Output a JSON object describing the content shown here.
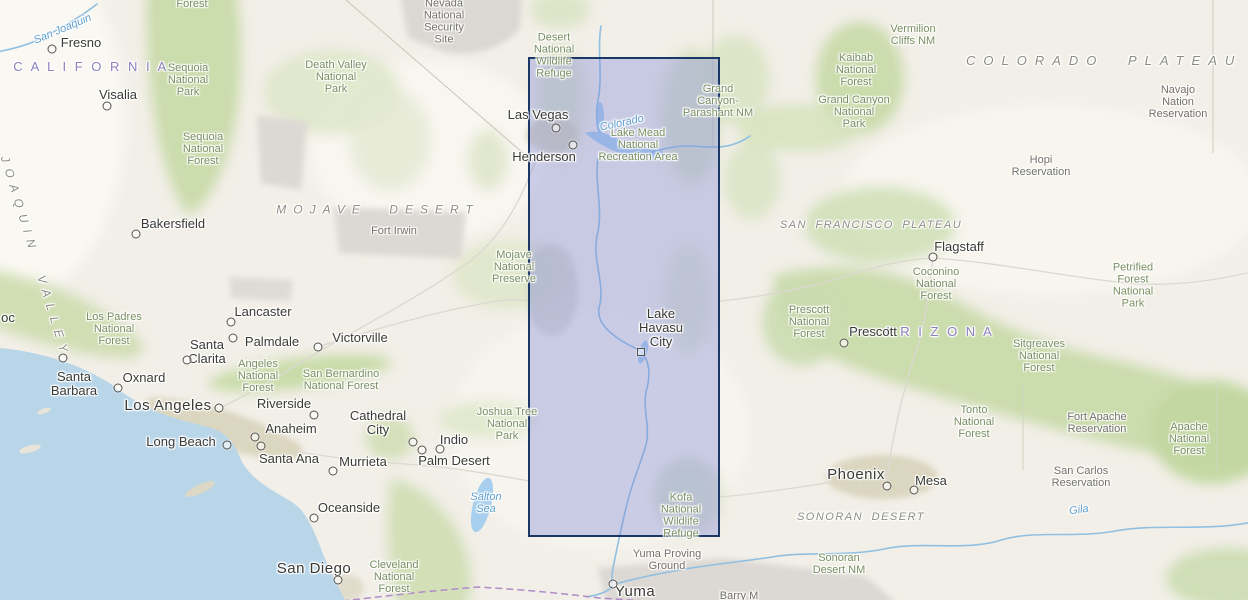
{
  "map": {
    "colors": {
      "base": "#f2efe8",
      "ocean": "#b9d6e9",
      "lake": "#a8d0ee",
      "river": "#8fc0e2",
      "forest": "#c6d9a6",
      "selection_fill": "rgba(125,132,215,0.36)",
      "selection_border": "#1b3766",
      "state_label": "#8d80bd",
      "park_label": "#7a8f63",
      "city_label": "#3a3a37",
      "river_label": "#5f9fcd"
    },
    "selection_rectangle": {
      "left": 528,
      "top": 57,
      "width": 192,
      "height": 480
    },
    "city_labels": [
      {
        "name": "Fresno",
        "x": 81,
        "y": 43,
        "dot_x": 52,
        "dot_y": 49
      },
      {
        "name": "Visalia",
        "x": 118,
        "y": 95,
        "dot_x": 107,
        "dot_y": 106
      },
      {
        "name": "Bakersfield",
        "x": 173,
        "y": 224,
        "dot_x": 136,
        "dot_y": 234
      },
      {
        "name": "Las Vegas",
        "x": 538,
        "y": 115,
        "dot_x": 556,
        "dot_y": 128
      },
      {
        "name": "Henderson",
        "x": 544,
        "y": 157,
        "dot_x": 573,
        "dot_y": 145
      },
      {
        "name": "Lancaster",
        "x": 263,
        "y": 312,
        "dot_x": 231,
        "dot_y": 322
      },
      {
        "name": "Santa\nClarita",
        "x": 207,
        "y": 352,
        "dot_x": 187,
        "dot_y": 360
      },
      {
        "name": "Palmdale",
        "x": 272,
        "y": 342,
        "dot_x": 233,
        "dot_y": 338
      },
      {
        "name": "Victorville",
        "x": 360,
        "y": 338,
        "dot_x": 318,
        "dot_y": 347
      },
      {
        "name": "Santa\nBarbara",
        "x": 74,
        "y": 384,
        "dot_x": 63,
        "dot_y": 358
      },
      {
        "name": "Oxnard",
        "x": 144,
        "y": 378,
        "dot_x": 118,
        "dot_y": 388
      },
      {
        "name": "Los Angeles",
        "x": 168,
        "y": 406,
        "dot_x": 219,
        "dot_y": 408,
        "major": true
      },
      {
        "name": "Riverside",
        "x": 284,
        "y": 404,
        "dot_x": 314,
        "dot_y": 415
      },
      {
        "name": "Anaheim",
        "x": 291,
        "y": 429,
        "dot_x": 255,
        "dot_y": 437
      },
      {
        "name": "Long Beach",
        "x": 181,
        "y": 442,
        "dot_x": 227,
        "dot_y": 445
      },
      {
        "name": "Santa Ana",
        "x": 289,
        "y": 459,
        "dot_x": 261,
        "dot_y": 446
      },
      {
        "name": "Murrieta",
        "x": 363,
        "y": 462,
        "dot_x": 333,
        "dot_y": 471
      },
      {
        "name": "Cathedral\nCity",
        "x": 378,
        "y": 423,
        "dot_x": 413,
        "dot_y": 442
      },
      {
        "name": "Indio",
        "x": 454,
        "y": 440,
        "dot_x": 440,
        "dot_y": 449
      },
      {
        "name": "Palm Desert",
        "x": 454,
        "y": 461,
        "dot_x": 422,
        "dot_y": 450
      },
      {
        "name": "Lake\nHavasu\nCity",
        "x": 661,
        "y": 328,
        "dot_x": 641,
        "dot_y": 352,
        "marker": "square"
      },
      {
        "name": "Flagstaff",
        "x": 959,
        "y": 247,
        "dot_x": 933,
        "dot_y": 257
      },
      {
        "name": "Prescott",
        "x": 873,
        "y": 332,
        "dot_x": 844,
        "dot_y": 343
      },
      {
        "name": "Phoenix",
        "x": 856,
        "y": 475,
        "dot_x": 887,
        "dot_y": 486,
        "major": true
      },
      {
        "name": "Mesa",
        "x": 931,
        "y": 481,
        "dot_x": 914,
        "dot_y": 490
      },
      {
        "name": "Oceanside",
        "x": 349,
        "y": 508,
        "dot_x": 314,
        "dot_y": 518
      },
      {
        "name": "San Diego",
        "x": 314,
        "y": 569,
        "dot_x": 338,
        "dot_y": 580,
        "major": true
      },
      {
        "name": "Yuma",
        "x": 635,
        "y": 592,
        "dot_x": 613,
        "dot_y": 584,
        "major": true
      },
      {
        "name": "oc",
        "x": 8,
        "y": 318
      }
    ],
    "park_labels": [
      {
        "text": "Forest",
        "x": 192,
        "y": 5
      },
      {
        "text": "Sequoia\nNational\nPark",
        "x": 188,
        "y": 81
      },
      {
        "text": "Sequoia\nNational\nForest",
        "x": 203,
        "y": 150
      },
      {
        "text": "Death Valley\nNational\nPark",
        "x": 336,
        "y": 78
      },
      {
        "text": "Desert\nNational\nWildlife\nRefuge",
        "x": 554,
        "y": 56
      },
      {
        "text": "Lake Mead\nNational\nRecreation Area",
        "x": 638,
        "y": 146
      },
      {
        "text": "Grand\nCanyon-\nParashant NM",
        "x": 718,
        "y": 102
      },
      {
        "text": "Vermilion\nCliffs NM",
        "x": 913,
        "y": 36
      },
      {
        "text": "Kaibab\nNational\nForest",
        "x": 856,
        "y": 71
      },
      {
        "text": "Grand Canyon\nNational\nPark",
        "x": 854,
        "y": 113
      },
      {
        "text": "Coconino\nNational\nForest",
        "x": 936,
        "y": 285
      },
      {
        "text": "Petrified\nForest\nNational\nPark",
        "x": 1133,
        "y": 286
      },
      {
        "text": "Sitgreaves\nNational\nForest",
        "x": 1039,
        "y": 357
      },
      {
        "text": "Prescott\nNational\nForest",
        "x": 809,
        "y": 323
      },
      {
        "text": "Tonto\nNational\nForest",
        "x": 974,
        "y": 423
      },
      {
        "text": "Apache\nNational\nForest",
        "x": 1189,
        "y": 440
      },
      {
        "text": "Mojave\nNational\nPreserve",
        "x": 514,
        "y": 268
      },
      {
        "text": "Los Padres\nNational\nForest",
        "x": 114,
        "y": 330
      },
      {
        "text": "Angeles\nNational\nForest",
        "x": 258,
        "y": 377
      },
      {
        "text": "San Bernardino\nNational Forest",
        "x": 341,
        "y": 381
      },
      {
        "text": "Joshua Tree\nNational\nPark",
        "x": 507,
        "y": 425
      },
      {
        "text": "Cleveland\nNational\nForest",
        "x": 394,
        "y": 578
      },
      {
        "text": "Kofa\nNational\nWildlife\nRefuge",
        "x": 681,
        "y": 516
      },
      {
        "text": "Sonoran\nDesert NM",
        "x": 839,
        "y": 565
      }
    ],
    "admin_labels": [
      {
        "text": "Nevada\nNational\nSecurity\nSite",
        "x": 444,
        "y": 22
      },
      {
        "text": "Fort Irwin",
        "x": 394,
        "y": 232
      },
      {
        "text": "Hopi\nReservation",
        "x": 1041,
        "y": 167
      },
      {
        "text": "Navajo\nNation\nReservation",
        "x": 1178,
        "y": 103
      },
      {
        "text": "Fort Apache\nReservation",
        "x": 1097,
        "y": 424
      },
      {
        "text": "San Carlos\nReservation",
        "x": 1081,
        "y": 478
      },
      {
        "text": "Yuma Proving\nGround",
        "x": 667,
        "y": 561
      },
      {
        "text": "Barry M",
        "x": 739,
        "y": 597
      }
    ],
    "state_labels": [
      {
        "text": "CALIFORNIA",
        "x": 91,
        "y": 67
      },
      {
        "text": "ARIZONA",
        "x": 939,
        "y": 332
      }
    ],
    "physio_labels": [
      {
        "text": "MOJAVE DESERT",
        "x": 378,
        "y": 210
      },
      {
        "text": "SONORAN DESERT",
        "x": 861,
        "y": 518,
        "style": "small"
      },
      {
        "text": "COLORADO PLATEAU",
        "x": 966,
        "y": 61,
        "anchor": "left",
        "style": "big"
      },
      {
        "text": "SAN FRANCISCO PLATEAU",
        "x": 871,
        "y": 226,
        "style": "small"
      },
      {
        "text": "SAN JOAQUIN VALLEY",
        "x": 25,
        "y": 225,
        "rotate": 73
      }
    ],
    "river_labels": [
      {
        "text": "San Joaquin",
        "x": 63,
        "y": 30,
        "rotate": -23
      },
      {
        "text": "Colorado",
        "x": 622,
        "y": 124,
        "rotate": -12
      },
      {
        "text": "Salton\nSea",
        "x": 486,
        "y": 504
      },
      {
        "text": "Gila",
        "x": 1079,
        "y": 511,
        "rotate": -8
      }
    ]
  }
}
